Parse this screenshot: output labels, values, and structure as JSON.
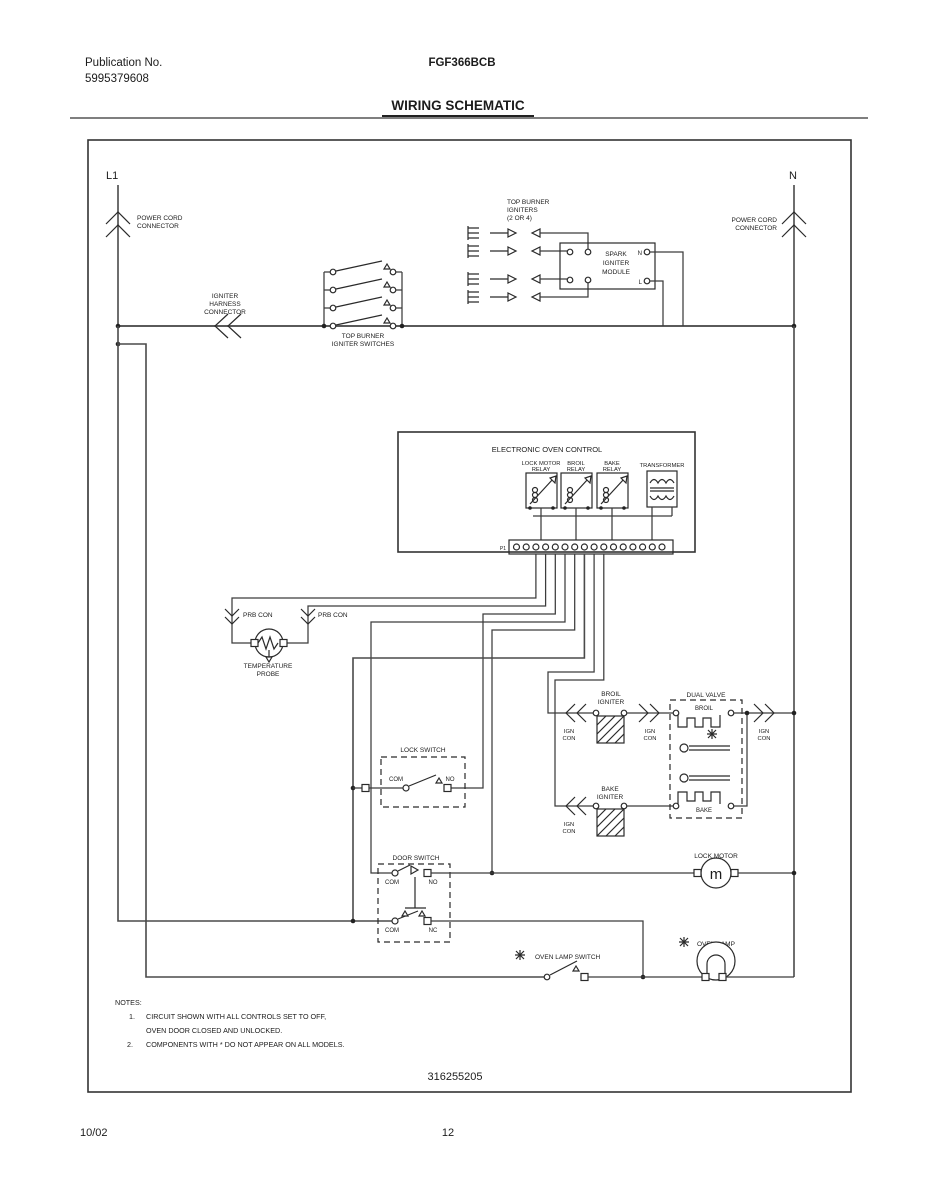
{
  "colors": {
    "ink": "#1c1c1c",
    "wire": "#3c3c3c",
    "background": "#ffffff"
  },
  "header": {
    "publication_label": "Publication No.",
    "publication_number": "5995379608",
    "model": "FGF366BCB",
    "title": "WIRING SCHEMATIC"
  },
  "footer": {
    "date": "10/02",
    "page": "12"
  },
  "schematic": {
    "part_number": "316255205",
    "l1": "L1",
    "neutral": "N",
    "power_cord_connector": [
      "POWER CORD",
      "CONNECTOR"
    ],
    "igniter_harness_connector": [
      "IGNITER",
      "HARNESS",
      "CONNECTOR"
    ],
    "top_burner_igniter_switches": [
      "TOP BURNER",
      "IGNITER SWITCHES"
    ],
    "top_burner_igniters": [
      "TOP BURNER",
      "IGNITERS",
      "(2 OR 4)"
    ],
    "spark_igniter_module": [
      "SPARK",
      "IGNITER",
      "MODULE"
    ],
    "module_n": "N",
    "module_l": "L",
    "eoc": {
      "title": "ELECTRONIC OVEN CONTROL",
      "lock_motor_relay": [
        "LOCK MOTOR",
        "RELAY"
      ],
      "broil_relay": [
        "BROIL",
        "RELAY"
      ],
      "bake_relay": [
        "BAKE",
        "RELAY"
      ],
      "transformer": "TRANSFORMER",
      "connector_label": "P1"
    },
    "prb_con": "PRB CON",
    "temperature_probe": [
      "TEMPERATURE",
      "PROBE"
    ],
    "lock_switch": {
      "title": "LOCK SWITCH",
      "com": "COM",
      "no": "NO"
    },
    "door_switch": {
      "title": "DOOR SWITCH",
      "com": "COM",
      "no": "NO",
      "nc": "NC"
    },
    "broil_igniter": [
      "BROIL",
      "IGNITER"
    ],
    "bake_igniter": [
      "BAKE",
      "IGNITER"
    ],
    "ign_con": [
      "IGN",
      "CON"
    ],
    "dual_valve": {
      "title": "DUAL VALVE",
      "broil": "BROIL",
      "bake": "BAKE"
    },
    "lock_motor": "LOCK MOTOR",
    "motor_m": "m",
    "oven_lamp_switch": "OVEN LAMP SWITCH",
    "oven_lamp": "OVEN LAMP",
    "notes": {
      "heading": "NOTES:",
      "n1": "1.",
      "note1_line1": "CIRCUIT SHOWN WITH ALL CONTROLS SET TO OFF,",
      "note1_line2": "OVEN DOOR CLOSED AND UNLOCKED.",
      "n2": "2.",
      "note2": "COMPONENTS WITH * DO NOT APPEAR ON ALL MODELS."
    }
  }
}
